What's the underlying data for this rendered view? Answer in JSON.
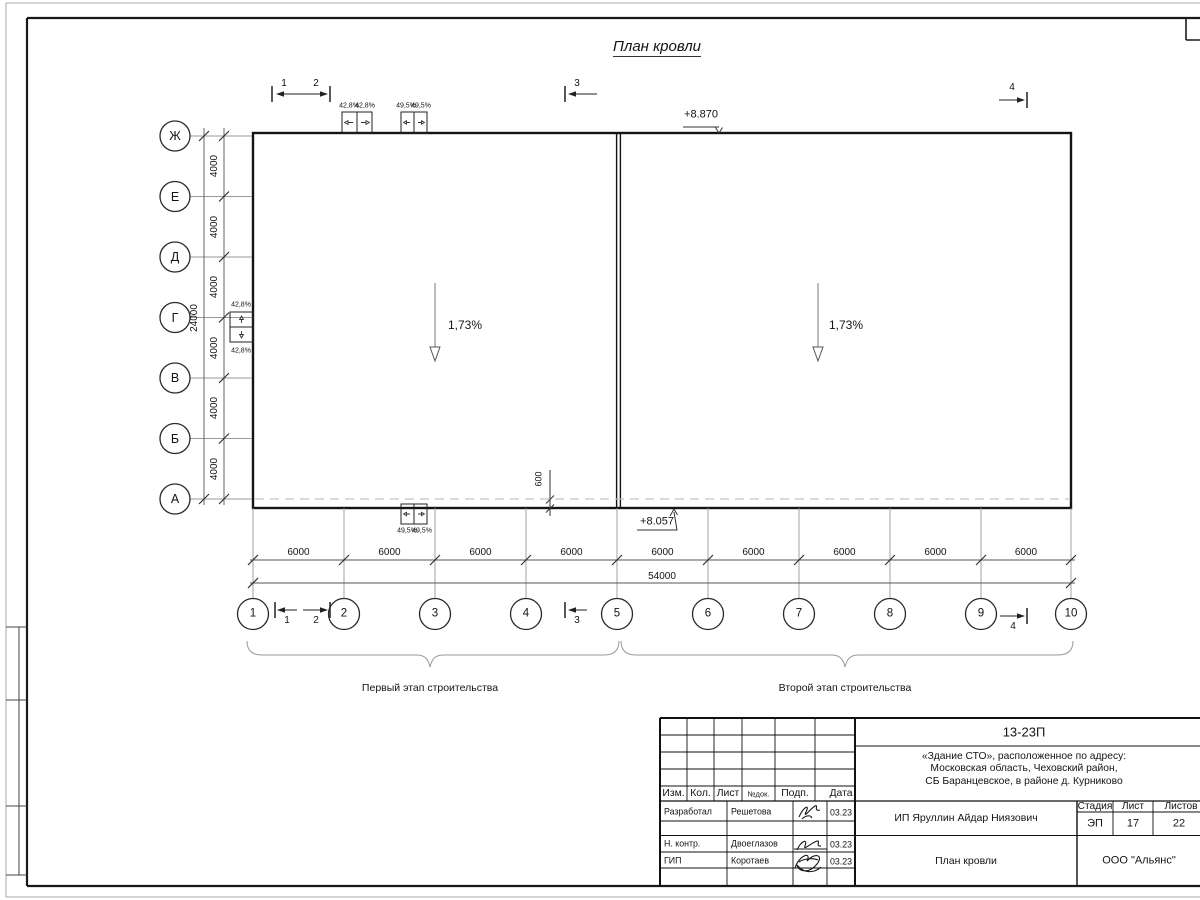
{
  "sheet": {
    "title": "План кровли"
  },
  "grid": {
    "rows": [
      "Ж",
      "Е",
      "Д",
      "Г",
      "В",
      "Б",
      "А"
    ],
    "cols": [
      "1",
      "2",
      "3",
      "4",
      "5",
      "6",
      "7",
      "8",
      "9",
      "10"
    ],
    "row_spacing": "4000",
    "row_total": "24000",
    "col_spacing": "6000",
    "col_total": "54000"
  },
  "sections": [
    "1",
    "2",
    "3",
    "4"
  ],
  "roof": {
    "slope": "1,73%",
    "elev_top": "+8.870",
    "elev_bottom": "+8.057",
    "overhang": "600",
    "funnel_slope_a": "42,8%",
    "funnel_slope_b": "49,5%"
  },
  "stages": {
    "first": "Первый этап строительства",
    "second": "Второй этап строительства"
  },
  "titleblock": {
    "doc_number": "13-23П",
    "project_line1": "«Здание СТО», расположенное по адресу:",
    "project_line2": "Московская область, Чеховский район,",
    "project_line3": "СБ Баранцевское, в районе д. Курниково",
    "header": {
      "izm": "Изм.",
      "kol": "Кол.",
      "list": "Лист",
      "ndok": "№док.",
      "podp": "Подп.",
      "data": "Дата"
    },
    "rows": [
      {
        "role": "Разработал",
        "name": "Решетова",
        "date": "03.23"
      },
      {
        "role": "Н. контр.",
        "name": "Двоеглазов",
        "date": "03.23"
      },
      {
        "role": "ГИП",
        "name": "Коротаев",
        "date": "03.23"
      }
    ],
    "client": "ИП Яруллин Айдар Ниязович",
    "sheet_name": "План кровли",
    "stage_label": "Стадия",
    "sheet_label": "Лист",
    "sheets_label": "Листов",
    "stage": "ЭП",
    "sheet_no": "17",
    "sheets_total": "22",
    "org": "ООО \"Альянс\""
  }
}
